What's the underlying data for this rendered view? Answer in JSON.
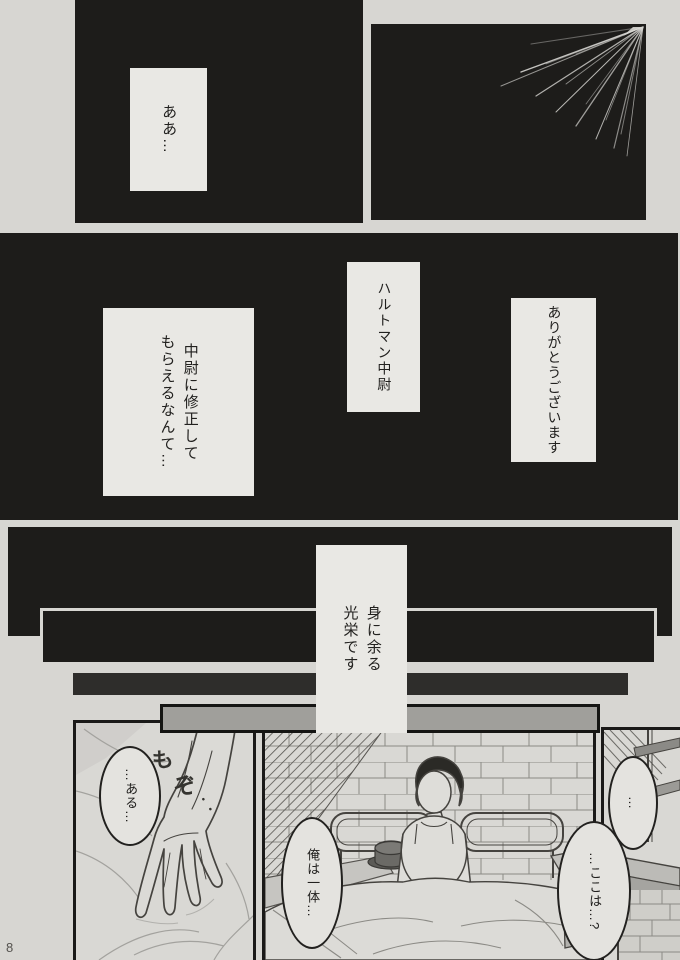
{
  "page": {
    "number": "8"
  },
  "colors": {
    "paper": "#d7d6d2",
    "panel_black": "#1d1c1a",
    "caption_box": "#e9e8e4",
    "bubble_fill": "#e4e3df",
    "ink_line": "#45433f",
    "bar_dark_gray": "#2e2d2b",
    "bar_light_gray": "#a09f9b"
  },
  "captions": {
    "top_left": "ああ…",
    "mid_left": "中尉に修正して\nもらえるなんて…",
    "mid_center": "ハルトマン中尉",
    "mid_right": "ありがとうございます",
    "honor": "身に余る\n光栄です"
  },
  "bubbles": {
    "aru": "…ある…",
    "ore": "俺は一体…",
    "dots": "…",
    "koko": "…ここは…?"
  },
  "sfx": {
    "char1": "も",
    "char2": "ぞ",
    "dots": "・・"
  }
}
